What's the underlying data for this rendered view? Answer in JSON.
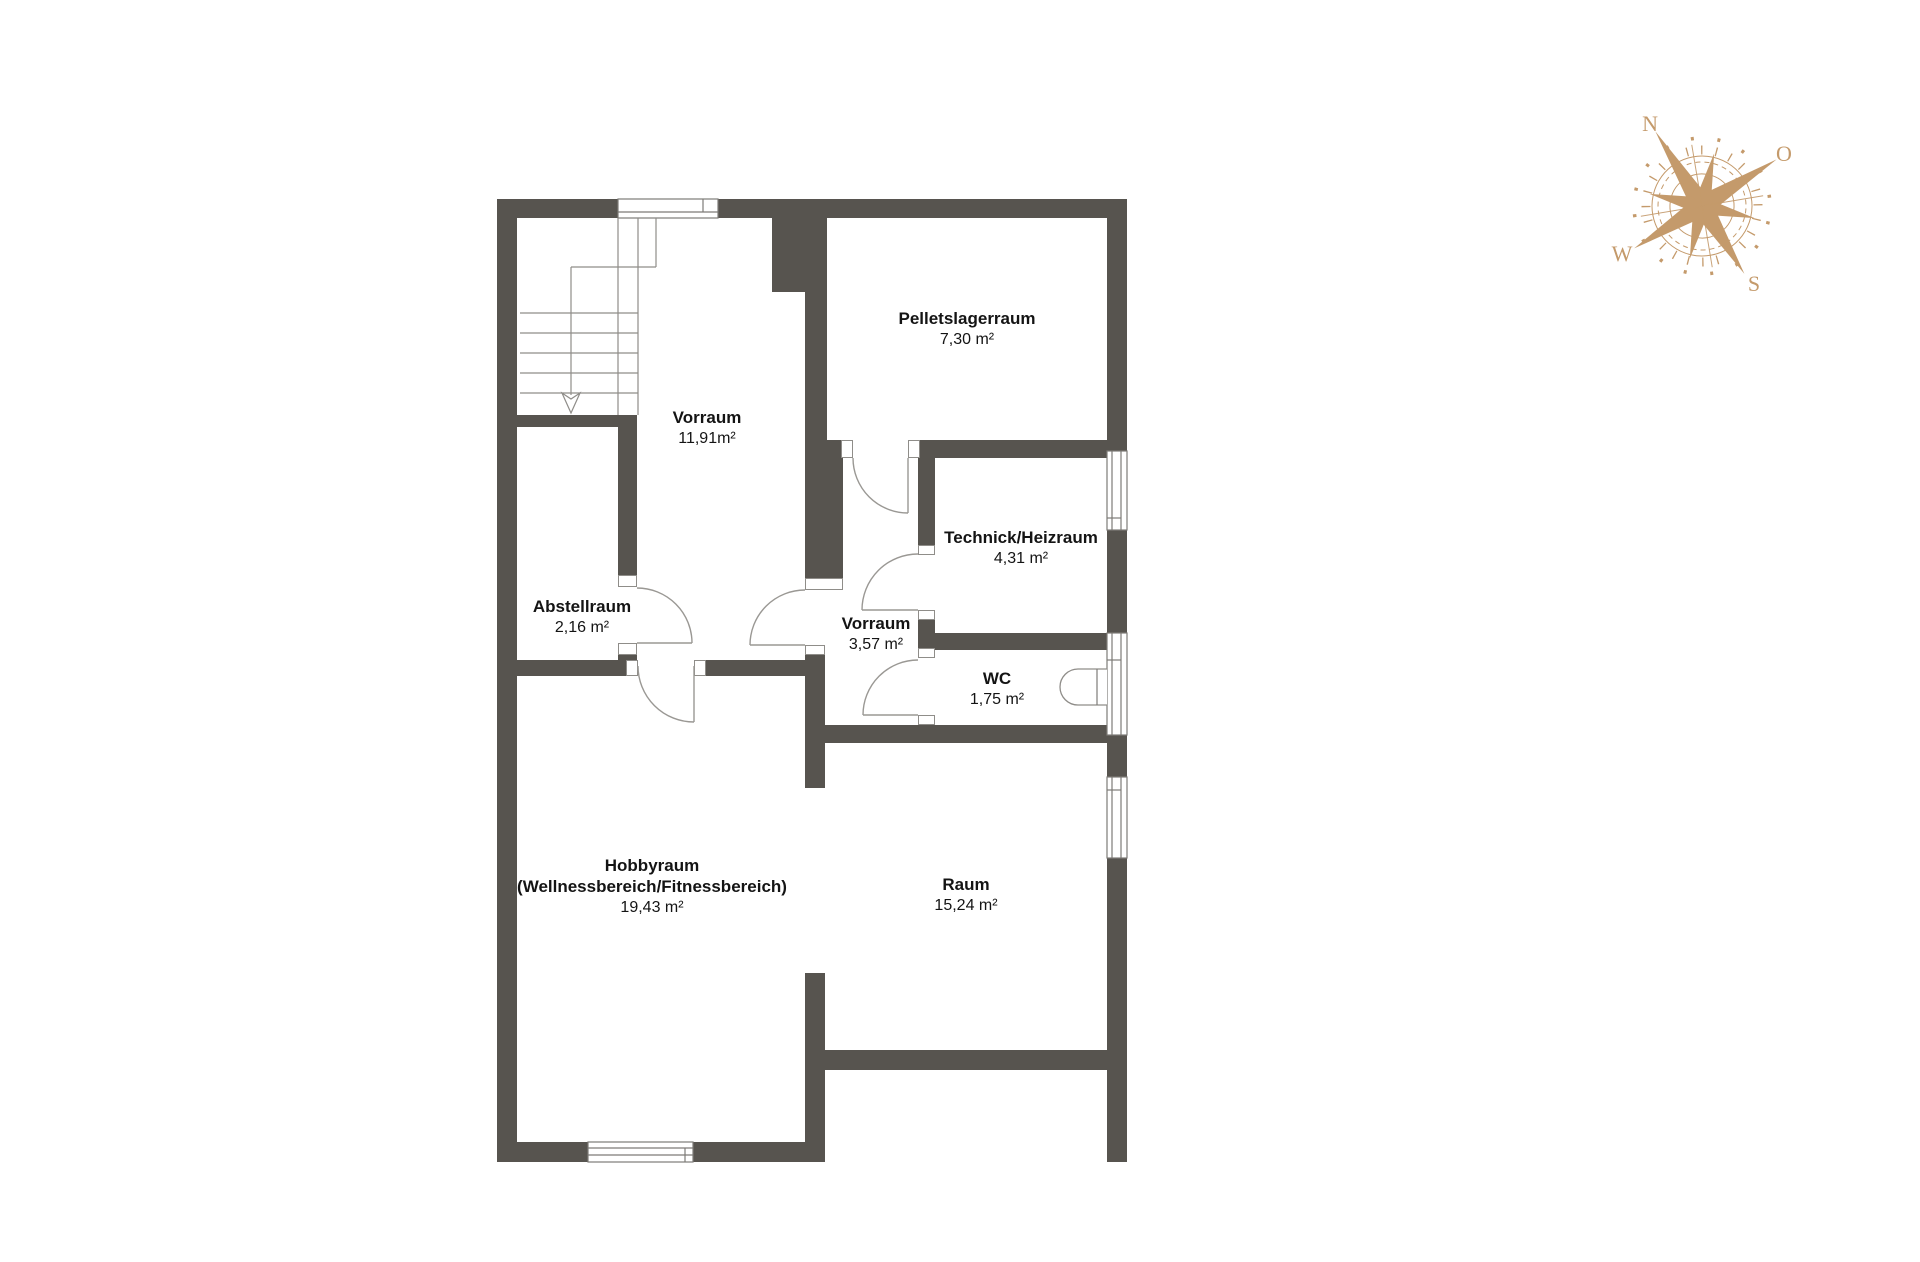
{
  "floorplan": {
    "rooms": {
      "vorraum_main": {
        "name": "Vorraum",
        "area": "11,91m²"
      },
      "pelletslager": {
        "name": "Pelletslagerraum",
        "area": "7,30 m²"
      },
      "technik": {
        "name": "Technick/Heizraum",
        "area": "4,31 m²"
      },
      "abstellraum": {
        "name": "Abstellraum",
        "area": "2,16 m²"
      },
      "vorraum_small": {
        "name": "Vorraum",
        "area": "3,57 m²"
      },
      "wc": {
        "name": "WC",
        "area": "1,75 m²"
      },
      "hobbyraum": {
        "name": "Hobbyraum",
        "name2": "(Wellnessbereich/Fitnessbereich)",
        "area": "19,43 m²"
      },
      "raum": {
        "name": "Raum",
        "area": "15,24 m²"
      }
    },
    "compass": {
      "n": "N",
      "o": "O",
      "s": "S",
      "w": "W"
    },
    "colors": {
      "wall": "#57544f",
      "compass": "#c49a6b"
    }
  }
}
